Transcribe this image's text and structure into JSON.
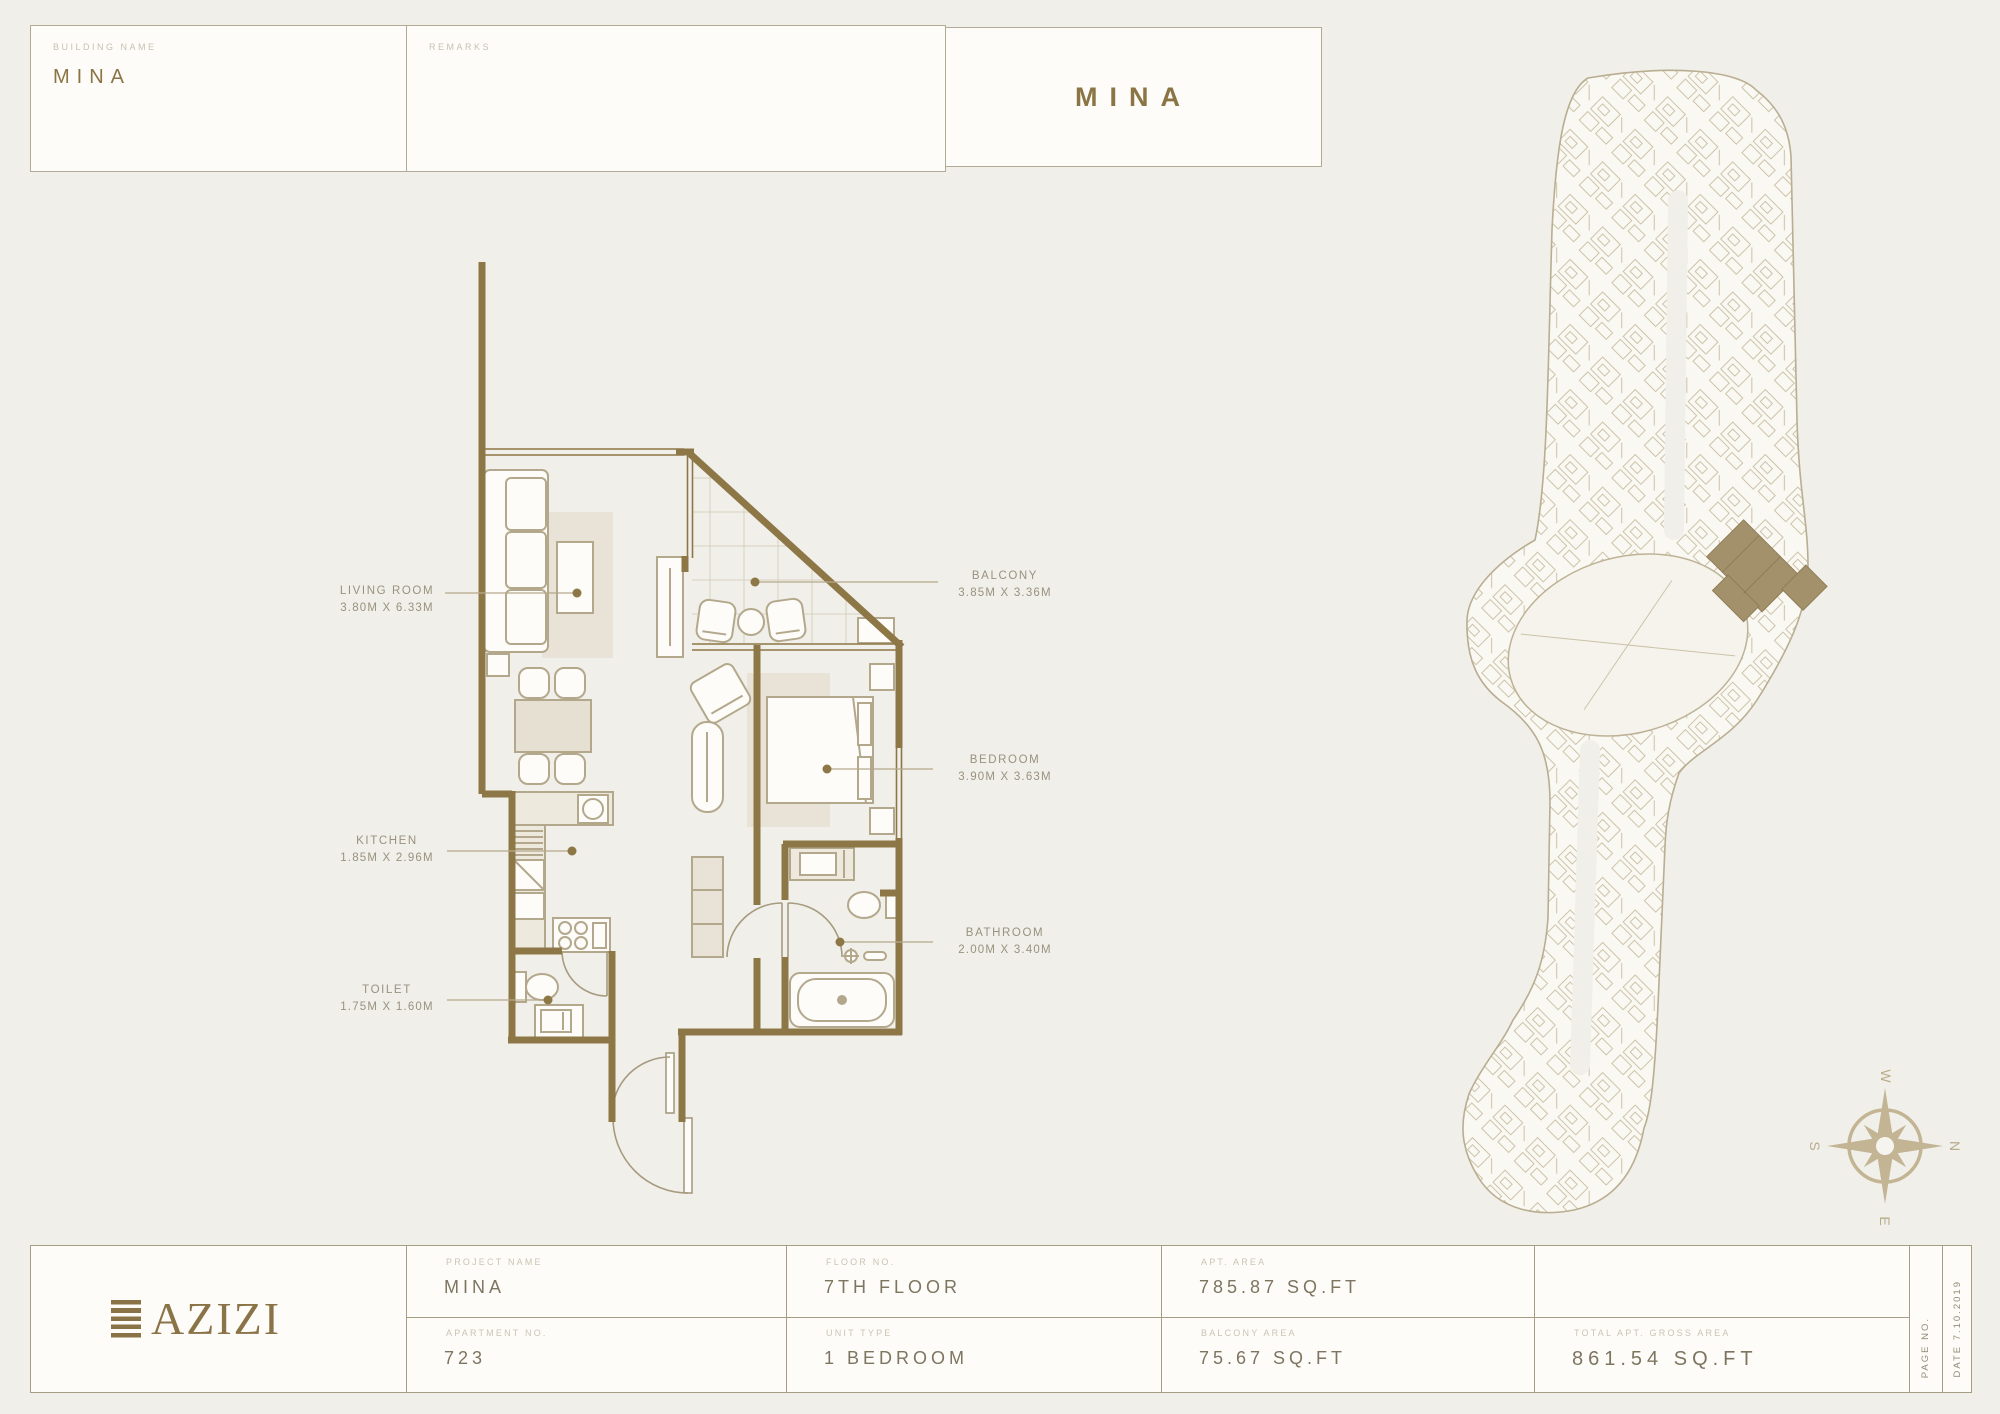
{
  "header": {
    "building_name_label": "BUILDING NAME",
    "building_name_value": "MINA",
    "remarks_label": "REMARKS",
    "title": "MINA"
  },
  "floor_plan": {
    "rooms": [
      {
        "name": "LIVING ROOM",
        "dimensions": "3.80M X 6.33M"
      },
      {
        "name": "BALCONY",
        "dimensions": "3.85M X 3.36M"
      },
      {
        "name": "BEDROOM",
        "dimensions": "3.90M X 3.63M"
      },
      {
        "name": "KITCHEN",
        "dimensions": "1.85M X 2.96M"
      },
      {
        "name": "TOILET",
        "dimensions": "1.75M X 1.60M"
      },
      {
        "name": "BATHROOM",
        "dimensions": "2.00M X 3.40M"
      }
    ]
  },
  "site_plan": {
    "compass": {
      "north": "N",
      "south": "S",
      "east": "E",
      "west": "W"
    }
  },
  "footer": {
    "logo_text": "AZIZI",
    "cells": [
      {
        "label": "PROJECT NAME",
        "value": "MINA"
      },
      {
        "label": "APARTMENT NO.",
        "value": "723"
      },
      {
        "label": "FLOOR NO.",
        "value": "7TH FLOOR"
      },
      {
        "label": "UNIT TYPE",
        "value": "1 BEDROOM"
      },
      {
        "label": "APT. AREA",
        "value": "785.87 SQ.FT"
      },
      {
        "label": "BALCONY AREA",
        "value": "75.67 SQ.FT"
      },
      {
        "label": "TOTAL APT. GROSS AREA",
        "value": "861.54 SQ.FT"
      }
    ],
    "page_no_label": "PAGE NO.",
    "date_label": "DATE 7.10.2019"
  },
  "colors": {
    "wall_gold": "#8d7746",
    "accent_gold": "#8b7544",
    "logo_gold": "#8a7347",
    "highlight_building": "#a3916b",
    "background": "#f1efe9"
  }
}
